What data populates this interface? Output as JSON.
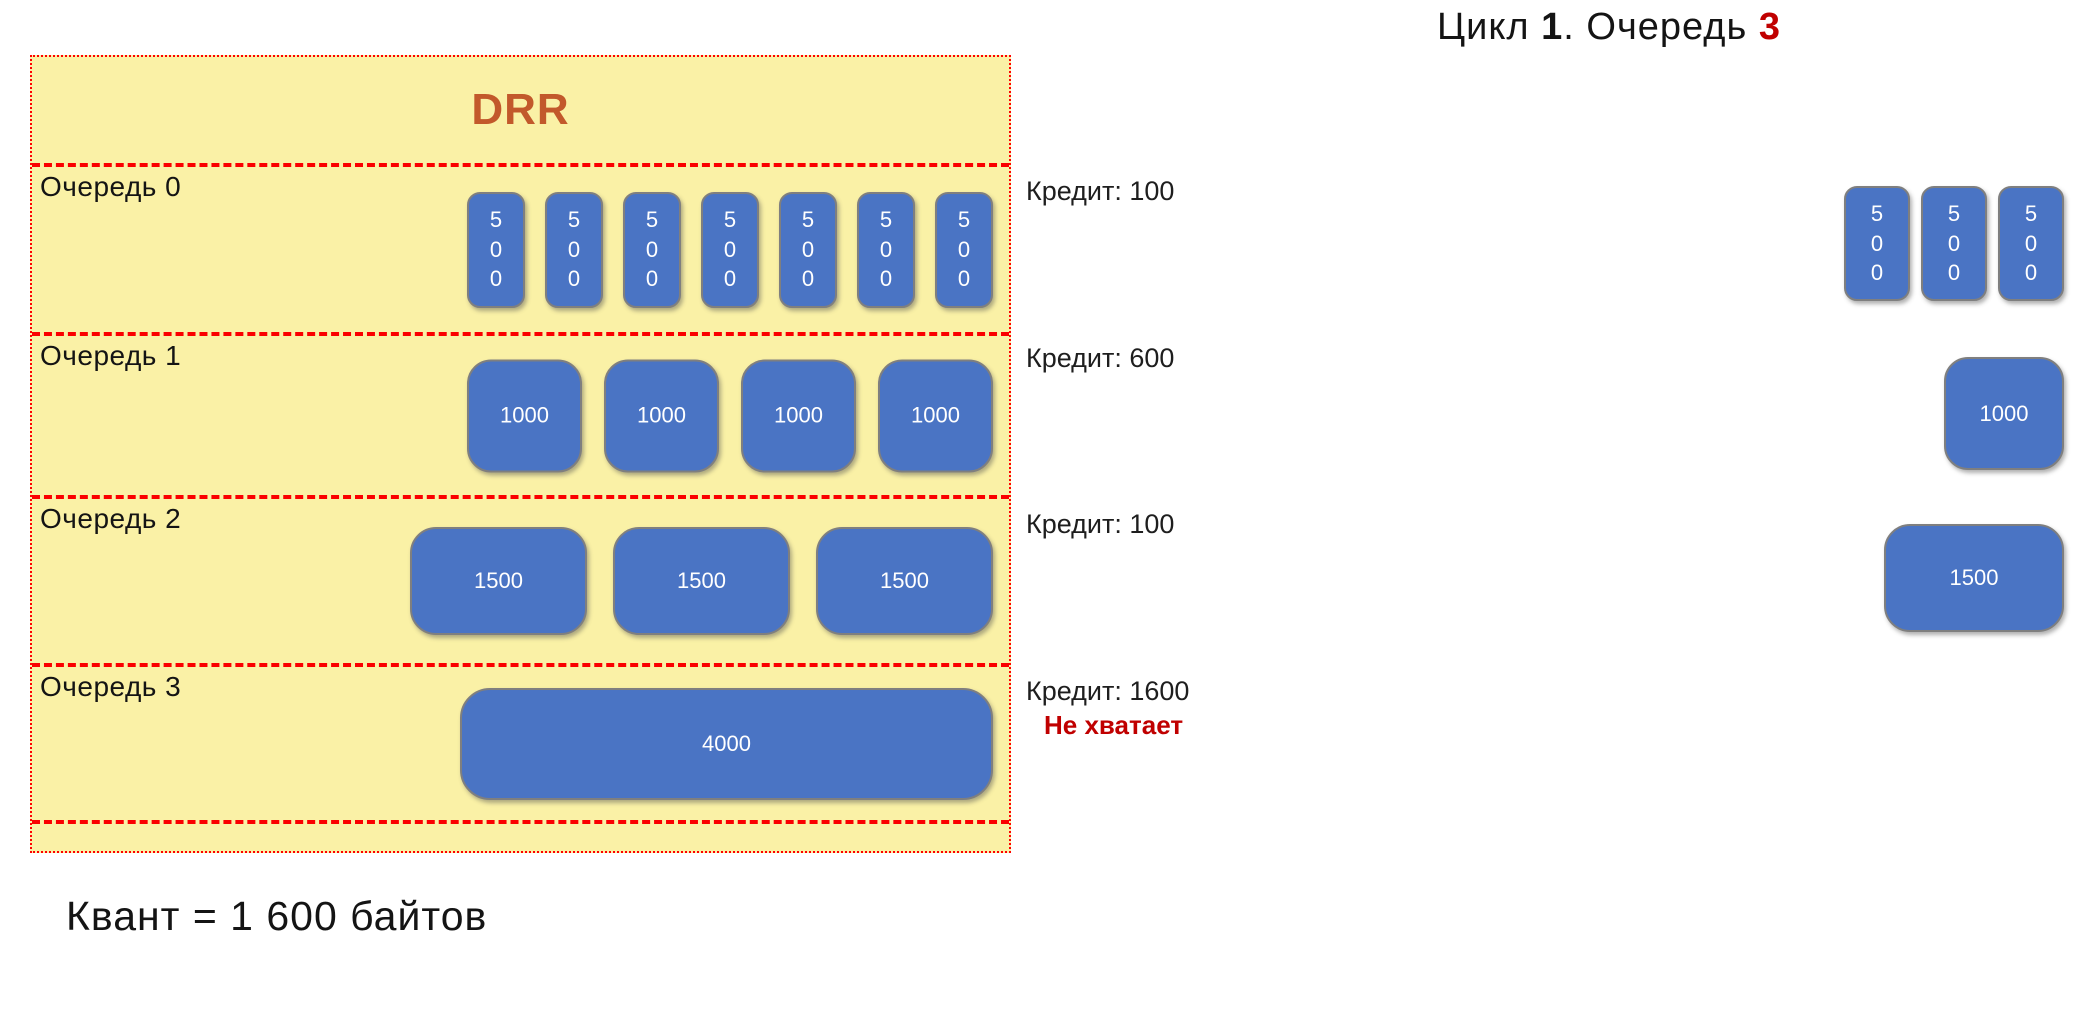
{
  "header": {
    "title_parts": [
      {
        "text": "Цикл ",
        "bold": false,
        "color": "#141414"
      },
      {
        "text": "1",
        "bold": true,
        "color": "#141414"
      },
      {
        "text": ". Очередь ",
        "bold": false,
        "color": "#141414"
      },
      {
        "text": "3",
        "bold": true,
        "color": "#C00000"
      }
    ]
  },
  "drr": {
    "title": "DRR",
    "queues": [
      {
        "label": "Очередь 0",
        "credit": "Кредит: 100",
        "packets": [
          "500",
          "500",
          "500",
          "500",
          "500",
          "500",
          "500"
        ]
      },
      {
        "label": "Очередь 1",
        "credit": "Кредит: 600",
        "packets": [
          "1000",
          "1000",
          "1000",
          "1000"
        ]
      },
      {
        "label": "Очередь 2",
        "credit": "Кредит: 100",
        "packets": [
          "1500",
          "1500",
          "1500"
        ]
      },
      {
        "label": "Очередь 3",
        "credit": "Кредит: 1600",
        "packets": [
          "4000"
        ],
        "note": "Не хватает"
      }
    ]
  },
  "output": {
    "packets": [
      {
        "size": "500"
      },
      {
        "size": "500"
      },
      {
        "size": "500"
      },
      {
        "size": "1000"
      },
      {
        "size": "1500"
      }
    ]
  },
  "footer": {
    "quantum_label": "Квант = 1 600 байтов"
  },
  "colors": {
    "box_fill": "#FAF1A6",
    "box_border": "#FF0000",
    "packet_fill": "#4A74C4",
    "packet_border": "#7F7F7F",
    "packet_text": "#FFFFFF",
    "drr_title": "#C2592B",
    "text": "#141414",
    "alert_red": "#C00000"
  }
}
